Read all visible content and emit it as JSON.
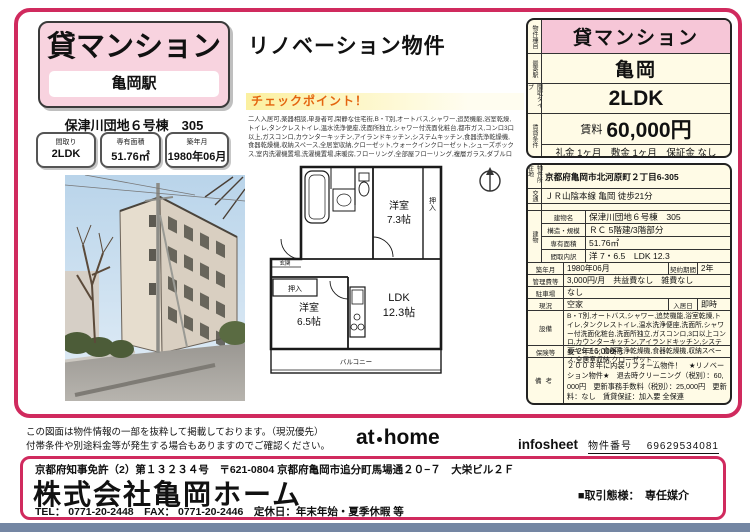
{
  "colors": {
    "accent_pink": "#d02a5e",
    "card_pink": "#f8d3df",
    "cell_pink": "#f6c6d7",
    "sheet_cream": "#fffbe6",
    "checkpoint_orange": "#e4650f",
    "footer_bar_blue": "#7486a3"
  },
  "left_card": {
    "title": "貸マンション",
    "station": "亀岡駅",
    "building_name": "保津川団地６号棟　305",
    "stats": [
      {
        "label": "間取り",
        "value": "2LDK"
      },
      {
        "label": "専有面積",
        "value": "51.76㎡"
      },
      {
        "label": "築年月",
        "value": "1980年06月"
      }
    ]
  },
  "middle": {
    "headline": "リノベーション物件",
    "checkpoint_title": "チェックポイント！",
    "features_text": "二人入居可,楽器相談,単身者可,閑静な住宅街,B・T別,オートバス,シャワー,追焚機能,浴室乾燥,トイレ,タンクレストイレ,温水洗浄便座,洗面所独立,シャワー付洗面化粧台,都市ガス,コンロ3口以上,ガスコンロ,カウンターキッチン,アイランドキッチン,システムキッチン,食器洗浄乾燥機,食器乾燥機,収納スペース,全居室収納,クローゼット,ウォークインクローゼット,シューズボックス,室内洗濯機置場,洗濯機置場,床暖房,フローリング,全部屋フローリング,複層ガラス,ダブルロックキードア,モニタ付インターホン,ディンプルキー,バルコニー,敷地内ゴミ置場,駐輪スペース,専用庭,駐車場近隣",
    "floorplan": {
      "room1_name": "洋室",
      "room1_size": "7.3帖",
      "room2_name": "洋室",
      "room2_size": "6.5帖",
      "ldk_name": "LDK",
      "ldk_size": "12.3帖",
      "closet1": "押入",
      "closet2": "押入",
      "balcony": "バルコニー",
      "entrance": "玄関"
    }
  },
  "summary": {
    "type_label": "物件種目",
    "type_value": "貸マンション",
    "station_label": "最寄駅",
    "station_value": "亀岡",
    "layout_label": "間取タイプ",
    "layout_value": "2LDK",
    "conditions_label": "賃貸条件",
    "rent_label": "賃料",
    "rent_value": "60,000円",
    "terms": "礼金 1ヶ月　敷金 1ヶ月　保証金 なし"
  },
  "detail": {
    "address_label": "物件所在地",
    "address": "京都府亀岡市北河原町２丁目6-305",
    "access_label": "交通",
    "access": "ＪＲ山陰本線 亀岡 徒歩21分",
    "building_label": "建物",
    "building_rows": [
      {
        "label": "建物名",
        "value": "保津川団地６号棟　305"
      },
      {
        "label": "構造・規模",
        "value": "ＲＣ 5階建/3階部分"
      },
      {
        "label": "専有面積",
        "value": "51.76㎡"
      },
      {
        "label": "間取内訳",
        "value": "洋 7・6.5　LDK 12.3"
      }
    ],
    "built_label": "築年月",
    "built": "1980年06月",
    "term_label": "契約期間",
    "term": "2年",
    "fee_label": "管理費等",
    "fee": "3,000円/月　共益費なし　雑費なし",
    "parking_label": "駐車場",
    "parking": "なし",
    "status_label": "現況",
    "status": "空家",
    "movein_label": "入居日",
    "movein": "即時",
    "equipment_label": "設備",
    "equipment": "B・T別,オートバス,シャワー,追焚機能,浴室乾燥,トイレ,タンクレストイレ,温水洗浄便座,洗面所,シャワー付洗面化粧台,洗面所独立,ガスコンロ,3口以上コンロ,カウンターキッチン,アイランドキッチン,システムキッチン,食器洗浄乾燥機,食器乾燥機,収納スペース,全居室収納,クローゼット…",
    "insurance_label": "保険等",
    "insurance": "要 2年16,000円",
    "notes_label": "備考",
    "notes": "２００８年に内装リフォーム物件！　★リノベーション物件★　退去時クリーニング（税別）：60,000円　更新事務手数料（税別）：25,000円　更新料：なし　賃貸保証：加入要 全保連"
  },
  "footer": {
    "disclaimer_line1": "この図面は物件情報の一部を抜粋して掲載しております。（現況優先）",
    "disclaimer_line2": "付帯条件や別途料金等が発生する場合もありますのでご確認ください。",
    "logo_part1": "at",
    "logo_part2": "home",
    "infosheet_label": "infosheet",
    "property_no_label": "物件番号",
    "property_no": "69629534081"
  },
  "company": {
    "license_line": "京都府知事免許（2）第１３２３４号　〒621-0804 京都府亀岡市追分町馬場通２０−７　大栄ビル２Ｆ",
    "name": "株式会社亀岡ホーム",
    "contact_line": "TEL： 0771-20-2448　FAX： 0771-20-2446　定休日：年末年始・夏季休暇 等",
    "deal_type": "■取引態様：　専任媒介"
  }
}
